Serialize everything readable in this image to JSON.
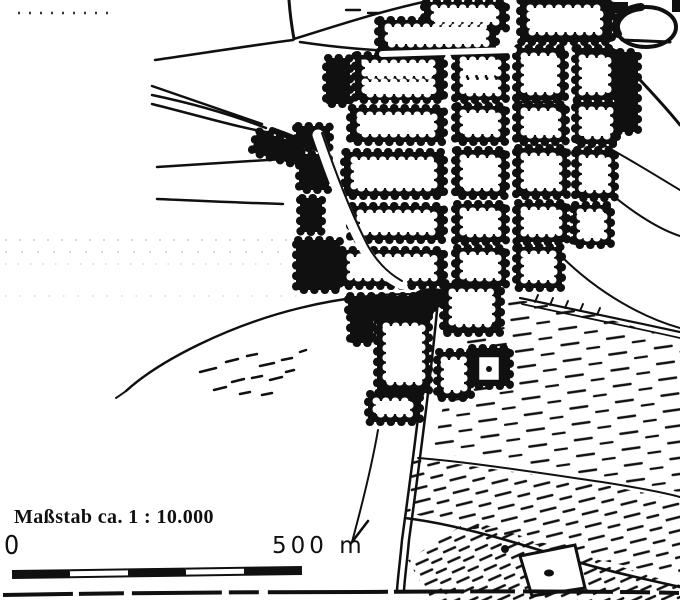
{
  "document": {
    "type": "scanned black-and-white town map",
    "paper_color": "#ffffff",
    "ink_color": "#101010"
  },
  "map": {
    "features": [
      "village-street-grid",
      "scalloped-building-blocks",
      "main-road-south",
      "railway-road-bundle-west",
      "field-boundary-arcs",
      "slope-hatching-southeast",
      "pond-northeast",
      "field-enclosure-south"
    ]
  },
  "scale": {
    "caption": "Maßstab ca. 1 : 10.000",
    "bar": {
      "start_label": "0",
      "end_label": "500 m",
      "total_m": 500,
      "segment_length_m": 100,
      "segments": [
        {
          "fill": "black"
        },
        {
          "fill": "white"
        },
        {
          "fill": "black"
        },
        {
          "fill": "white"
        },
        {
          "fill": "black"
        }
      ]
    }
  }
}
